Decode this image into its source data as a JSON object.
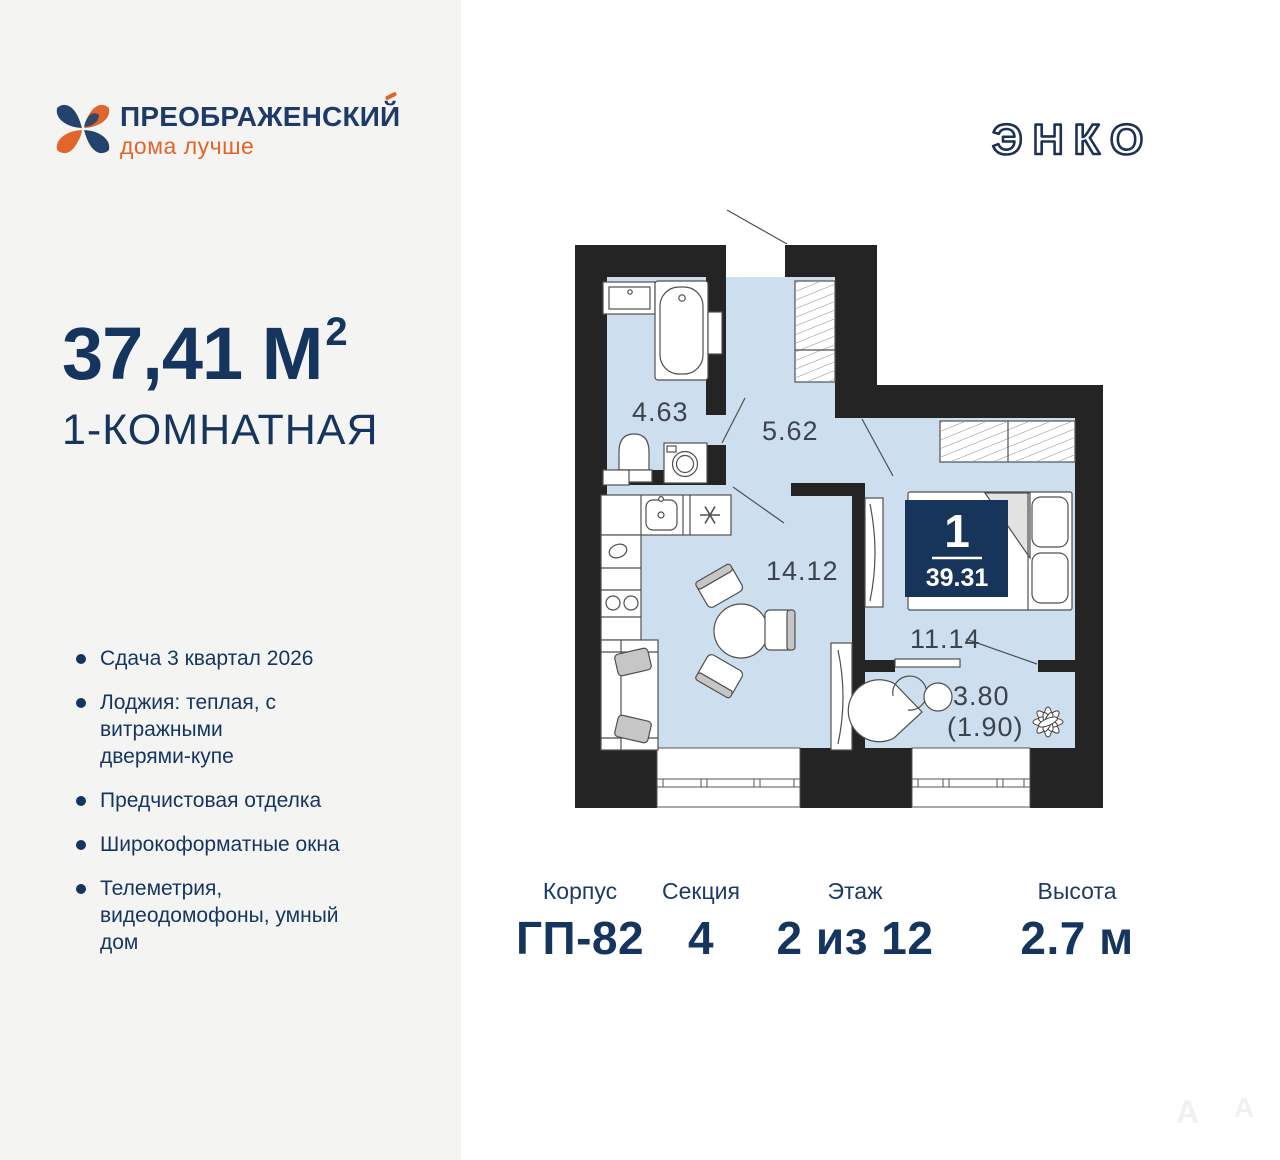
{
  "brand": {
    "name": "ПРЕОБРАЖЕНСКИЙ",
    "tagline": "дома лучше"
  },
  "developer": {
    "logo_text": "ЭНКО"
  },
  "listing": {
    "area_label": "37,41 М",
    "area_sup": "2",
    "type_label": "1-КОМНАТНАЯ"
  },
  "features": [
    {
      "lines": [
        "Сдача 3 квартал 2026"
      ]
    },
    {
      "lines": [
        "Лоджия: теплая, с",
        "витражными",
        "дверями-купе"
      ]
    },
    {
      "lines": [
        "Предчистовая отделка"
      ]
    },
    {
      "lines": [
        "Широкоформатные окна"
      ]
    },
    {
      "lines": [
        "Телеметрия,",
        "видеодомофоны, умный",
        "дом"
      ]
    }
  ],
  "plan": {
    "bathroom_area": "4.63",
    "hall_area": "5.62",
    "kitchen_area": "14.12",
    "bedroom_area": "11.14",
    "loggia_area": "3.80",
    "loggia_area_reduced": "(1.90)",
    "badge_rooms": "1",
    "badge_total_area": "39.31"
  },
  "stats": [
    {
      "label": "Корпус",
      "value": "ГП-82"
    },
    {
      "label": "Секция",
      "value": "4"
    },
    {
      "label": "Этаж",
      "value": "2 из 12"
    },
    {
      "label": "Высота",
      "value": "2.7 м"
    }
  ],
  "watermarks": {
    "first": "А",
    "second": "А"
  },
  "colors": {
    "navy": "#16355e",
    "orange": "#e2652b",
    "wall": "#242424",
    "room_fill": "#cddeee",
    "badge_bg": "#17345a",
    "panel_bg": "#f4f4f3"
  }
}
